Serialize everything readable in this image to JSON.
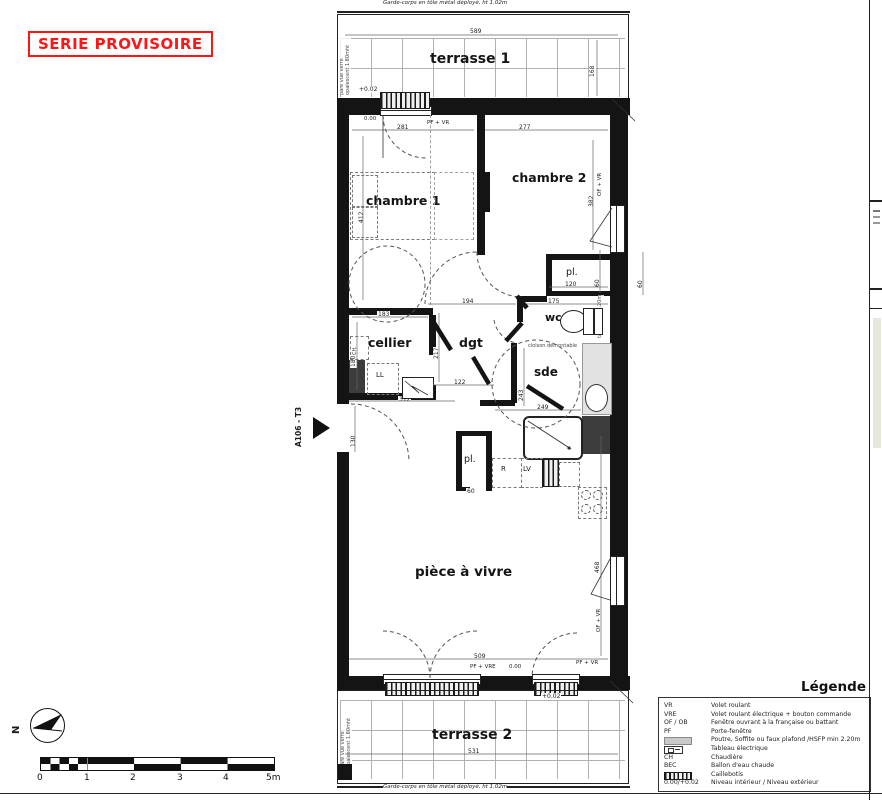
{
  "stamp": "SERIE PROVISOIRE",
  "unit_label": "A106 - T3",
  "north_label": "N",
  "texts": {
    "garde_corps_top": "Garde-corps en tôle métal déployé, ht 1.02m",
    "garde_corps_bottom": "Garde-corps en tôle métal déployé, ht 1.02m",
    "pare_vue_1": "pare vue verre opalescent 1.80mht",
    "pare_vue_2": "pare vue verre opalescent 1.80mht",
    "cloison": "cloison démontable",
    "tableau_note": "tableau ht 1.20m",
    "coffre": "coffre"
  },
  "rooms": {
    "terrasse1": "terrasse 1",
    "terrasse2": "terrasse 2",
    "chambre1": "chambre 1",
    "chambre2": "chambre 2",
    "cellier": "cellier",
    "dgt": "dgt",
    "wc": "wc",
    "sde": "sde",
    "pl_top": "pl.",
    "pl_bottom": "pl.",
    "piece": "pièce à vivre"
  },
  "appliances": {
    "ch": "CH.",
    "ll": "LL",
    "r": "R",
    "lv": "LV"
  },
  "levels": {
    "t1": "+0.02",
    "t2": "+0.02",
    "int_top": "0.00",
    "int_bottom": "0.00"
  },
  "windows": {
    "top": "PF + VR",
    "ch2_right": "OF + VR",
    "piece_right": "OF + VR",
    "bottom_left": "PF + VRE",
    "bottom_right": "PF + VR"
  },
  "dims": {
    "t1_w": "589",
    "t1_d": "168",
    "ch1_w": "281",
    "ch2_w": "277",
    "ch1_d": "412",
    "ch2_d": "382",
    "pl_top_w": "120",
    "pl_top_d": "60",
    "win_pier": "60",
    "dgt_w": "194",
    "wc_w": "175",
    "cellier_w": "183",
    "cellier_d": "180",
    "dgt_d": "217",
    "entry_w": "122",
    "entry_total": "312",
    "entry_door": "130",
    "sde_w": "249",
    "sde_d": "243",
    "pl_bottom_w": "60",
    "piece_w": "509",
    "piece_d": "468",
    "t2_w": "531"
  },
  "legend": {
    "title": "Légende",
    "rows": [
      {
        "key": "VR",
        "desc": "Volet roulant"
      },
      {
        "key": "VRE",
        "desc": "Volet roulant électrique + bouton commande"
      },
      {
        "key": "OF / OB",
        "desc": "Fenêtre ouvrant à la française ou battant"
      },
      {
        "key": "PF",
        "desc": "Porte-fenêtre"
      },
      {
        "key": "",
        "desc": "Poutre, Soffite ou faux plafond /HSFP min 2.20m"
      },
      {
        "key": "",
        "desc": "Tableau électrique"
      },
      {
        "key": "CH",
        "desc": "Chaudière"
      },
      {
        "key": "BEC",
        "desc": "Ballon d'eau chaude"
      },
      {
        "key": "",
        "desc": "Caillebotis"
      },
      {
        "key": "0.00/+0.02",
        "desc": "Niveau intérieur / Niveau extérieur"
      }
    ]
  },
  "scalebar": {
    "ticks": [
      "0",
      "1",
      "2",
      "3",
      "4",
      "5m"
    ]
  }
}
